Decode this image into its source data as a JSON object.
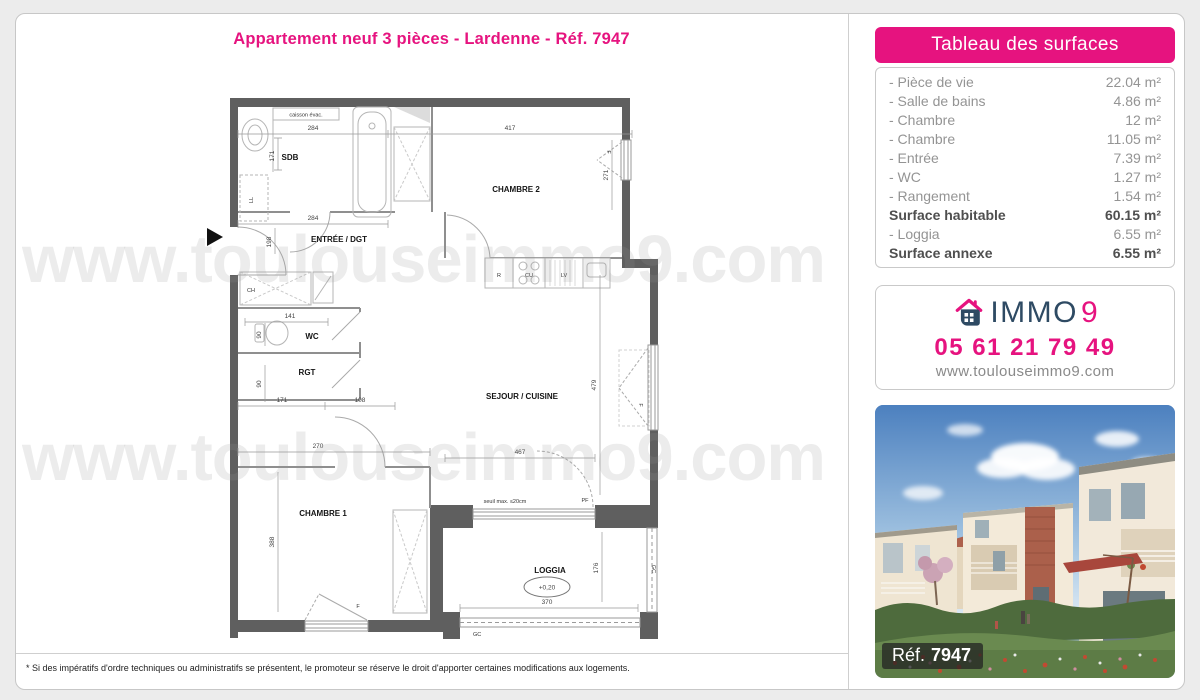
{
  "page": {
    "title": "Appartement neuf 3 pièces - Lardenne - Réf. 7947",
    "disclaimer": "* Si des impératifs d'ordre techniques ou administratifs se présentent, le promoteur se réserve le droit d'apporter certaines modifications aux logements."
  },
  "watermark": {
    "text": "www.toulouseimmo9.com"
  },
  "surfaces": {
    "header": "Tableau des surfaces",
    "rows": [
      {
        "label": "- Pièce de vie",
        "value": "22.04 m²"
      },
      {
        "label": "- Salle de bains",
        "value": "4.86 m²"
      },
      {
        "label": "- Chambre",
        "value": "12 m²"
      },
      {
        "label": "- Chambre",
        "value": "11.05 m²"
      },
      {
        "label": "- Entrée",
        "value": "7.39 m²"
      },
      {
        "label": "- WC",
        "value": "1.27 m²"
      },
      {
        "label": "- Rangement",
        "value": "1.54 m²"
      },
      {
        "label": "Surface habitable",
        "value": "60.15 m²"
      },
      {
        "label": "- Loggia",
        "value": "6.55 m²"
      },
      {
        "label": "Surface annexe",
        "value": "6.55 m²"
      }
    ]
  },
  "agency": {
    "brand_immo": "IMMO",
    "brand_9": "9",
    "phone": "05 61 21 79 49",
    "website": "www.toulouseimmo9.com"
  },
  "photo": {
    "ref_label": "Réf.",
    "ref_number": "7947"
  },
  "floorplan": {
    "rooms": {
      "sdb": "SDB",
      "chambre2": "CHAMBRE 2",
      "entree": "ENTRÉE / DGT",
      "wc": "WC",
      "rgt": "RGT",
      "sejour": "SEJOUR / CUISINE",
      "chambre1": "CHAMBRE 1",
      "loggia": "LOGGIA"
    },
    "annotations": {
      "caisson": "caisson évac.",
      "ll": "LL",
      "ch": "CH",
      "r": "R",
      "cu": "CU",
      "lv": "LV",
      "f": "F",
      "pf": "PF",
      "gc": "GC",
      "seuil": "seuil max. ≤20cm",
      "level": "+0,20"
    },
    "dims": {
      "sdb_w": "284",
      "sdb_h": "171",
      "ch2_w": "417",
      "ch2_h": "271",
      "entree_w": "284",
      "entree_h": "198",
      "wc_w": "141",
      "wc_h": "90",
      "rgt_h": "90",
      "rgt_w": "171",
      "rgt_w2": "108",
      "sejour_h": "479",
      "sejour_w": "467",
      "ch1_w": "270",
      "ch1_h": "388",
      "loggia_w": "370",
      "loggia_h": "176"
    },
    "colors": {
      "wall": "#5f5f5f",
      "accent": "#e6137f",
      "navy": "#2e4a63"
    }
  }
}
